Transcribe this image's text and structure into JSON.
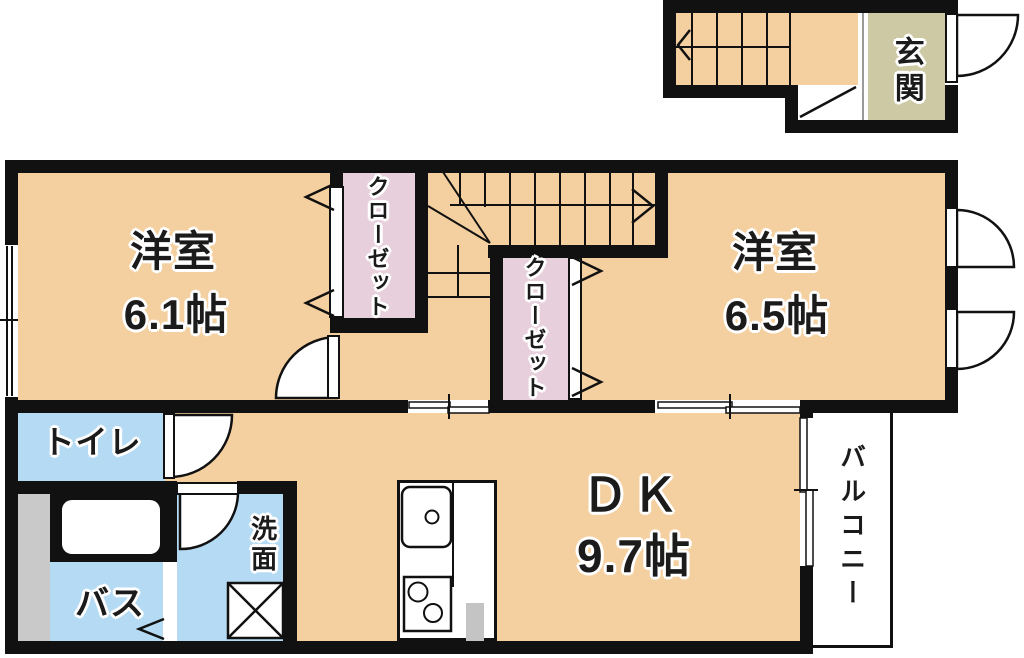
{
  "rooms": {
    "room1": {
      "label": "洋室",
      "size": "6.1帖"
    },
    "room2": {
      "label": "洋室",
      "size": "6.5帖"
    },
    "dining_kitchen": {
      "label": "ＤＫ",
      "size": "9.7帖"
    },
    "closet1": {
      "label": "クローゼット"
    },
    "closet2": {
      "label": "クローゼット"
    },
    "toilet": {
      "label": "トイレ"
    },
    "bath": {
      "label": "バス"
    },
    "washroom": {
      "label": "洗面"
    },
    "balcony": {
      "label": "バルコニー"
    },
    "entrance": {
      "label": "玄関"
    }
  },
  "colors": {
    "floor_orange": "#f4d0a0",
    "closet_pink": "#e7cfdc",
    "wet_area_blue": "#b5daf3",
    "entrance_beige": "#cdc9a4",
    "pipe_space_gray": "#c9c9c9",
    "wall_black": "#111111",
    "label_outline": "#ffffff"
  }
}
